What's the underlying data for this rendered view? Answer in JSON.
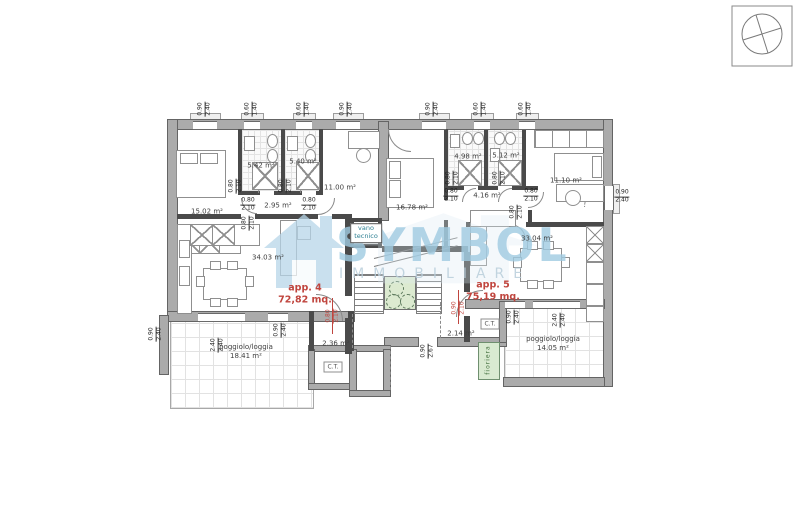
{
  "watermark": {
    "brand": "SYMBOL",
    "subtitle": "IMMOBILIARE"
  },
  "plan": {
    "colors": {
      "exterior_wall": "#ababab",
      "partition_wall": "#4a4a4a",
      "accent_red": "#c0453e",
      "green_planter": "#d9ead1",
      "elevator_green": "#dcead0",
      "watermark_blue": "#a0cbe2",
      "vano_tecnico_text": "#2c7f92"
    },
    "apartments": [
      {
        "name": "apartment-4-label",
        "label": "app. 4",
        "area": "72,82 mq.",
        "x": 305,
        "y": 295
      },
      {
        "name": "apartment-5-label",
        "label": "app. 5",
        "area": "75,19 mq.",
        "x": 493,
        "y": 292
      }
    ],
    "labels": [
      {
        "name": "room-label-15-02",
        "text": "15.02 m²",
        "x": 207,
        "y": 212,
        "cls": "rm"
      },
      {
        "name": "room-label-5-42",
        "text": "5.42 m²",
        "x": 261,
        "y": 166,
        "cls": "rm"
      },
      {
        "name": "room-label-5-40",
        "text": "5.40 m²",
        "x": 303,
        "y": 162,
        "cls": "rm"
      },
      {
        "name": "room-label-11-00",
        "text": "11.00 m²",
        "x": 340,
        "y": 188,
        "cls": "rm"
      },
      {
        "name": "room-label-2-95",
        "text": "2.95 m²",
        "x": 278,
        "y": 206,
        "cls": "rm"
      },
      {
        "name": "room-label-34-03",
        "text": "34.03 m²",
        "x": 268,
        "y": 258,
        "cls": "rm"
      },
      {
        "name": "room-label-16-78",
        "text": "16.78 m²",
        "x": 412,
        "y": 208,
        "cls": "rm"
      },
      {
        "name": "room-label-4-98",
        "text": "4.98 m²",
        "x": 468,
        "y": 157,
        "cls": "rm"
      },
      {
        "name": "room-label-5-12",
        "text": "5.12 m²",
        "x": 506,
        "y": 156,
        "cls": "rm"
      },
      {
        "name": "room-label-11-10",
        "text": "11.10 m²",
        "x": 566,
        "y": 181,
        "cls": "rm"
      },
      {
        "name": "room-label-4-16",
        "text": "4.16 m²",
        "x": 487,
        "y": 196,
        "cls": "rm"
      },
      {
        "name": "room-label-33-04",
        "text": "33.04 m²",
        "x": 537,
        "y": 239,
        "cls": "rm"
      },
      {
        "name": "room-label-2-36",
        "text": "2.36 m²",
        "x": 336,
        "y": 344,
        "cls": "rm"
      },
      {
        "name": "room-label-2-14",
        "text": "2.14 m²",
        "x": 461,
        "y": 334,
        "cls": "rm"
      },
      {
        "name": "loggia-label-left",
        "text": "poggiolo/loggia",
        "text2": "18.41 m²",
        "x": 246,
        "y": 352,
        "cls": "rm"
      },
      {
        "name": "loggia-label-right",
        "text": "poggiolo/loggia",
        "text2": "14.05 m²",
        "x": 553,
        "y": 344,
        "cls": "rm"
      },
      {
        "name": "vano-tecnico-label",
        "text": "vano",
        "text2": "tecnico",
        "x": 366,
        "y": 233,
        "cls": "vt"
      },
      {
        "name": "ct-label-left",
        "text": "C.T.",
        "x": 333,
        "y": 367,
        "cls": "ct"
      },
      {
        "name": "ct-label-right",
        "text": "C.T.",
        "x": 490,
        "y": 324,
        "cls": "ct"
      },
      {
        "name": "fioriera-label",
        "text": "fioriera",
        "x": 488,
        "y": 360,
        "cls": "fio",
        "rot": -90
      }
    ],
    "dims": [
      {
        "name": "dim-top-1",
        "num": "0.90",
        "den": "2.40",
        "x": 205,
        "y": 109,
        "rot": -90
      },
      {
        "name": "dim-top-2",
        "num": "0.60",
        "den": "1.40",
        "x": 252,
        "y": 109,
        "rot": -90
      },
      {
        "name": "dim-top-3",
        "num": "0.60",
        "den": "1.40",
        "x": 304,
        "y": 109,
        "rot": -90
      },
      {
        "name": "dim-top-4",
        "num": "0.90",
        "den": "2.40",
        "x": 347,
        "y": 109,
        "rot": -90
      },
      {
        "name": "dim-top-5",
        "num": "0.90",
        "den": "2.40",
        "x": 433,
        "y": 109,
        "rot": -90
      },
      {
        "name": "dim-top-6",
        "num": "0.60",
        "den": "1.40",
        "x": 481,
        "y": 109,
        "rot": -90
      },
      {
        "name": "dim-top-7",
        "num": "0.60",
        "den": "1.40",
        "x": 526,
        "y": 109,
        "rot": -90
      },
      {
        "name": "dim-right",
        "num": "0.90",
        "den": "2.40",
        "x": 622,
        "y": 197,
        "rot": 0
      },
      {
        "name": "dim-door-1",
        "num": "0.80",
        "den": "2.10",
        "x": 248,
        "y": 205,
        "rot": 0
      },
      {
        "name": "dim-door-2",
        "num": "0.80",
        "den": "2.10",
        "x": 309,
        "y": 205,
        "rot": 0
      },
      {
        "name": "dim-door-3",
        "num": "0.80",
        "den": "2.10",
        "x": 451,
        "y": 196,
        "rot": 0
      },
      {
        "name": "dim-door-4",
        "num": "0.80",
        "den": "2.10",
        "x": 531,
        "y": 196,
        "rot": 0
      },
      {
        "name": "dim-door-5",
        "num": "0.80",
        "den": "2.10",
        "x": 236,
        "y": 186,
        "rot": -90
      },
      {
        "name": "dim-door-6",
        "num": "0.80",
        "den": "2.10",
        "x": 286,
        "y": 186,
        "rot": -90
      },
      {
        "name": "dim-door-7",
        "num": "0.80",
        "den": "2.10",
        "x": 453,
        "y": 178,
        "rot": -90
      },
      {
        "name": "dim-door-8",
        "num": "0.80",
        "den": "2.10",
        "x": 500,
        "y": 178,
        "rot": -90
      },
      {
        "name": "dim-door-9",
        "num": "0.80",
        "den": "2.10",
        "x": 517,
        "y": 212,
        "rot": -90
      },
      {
        "name": "dim-door-10",
        "num": "0.80",
        "den": "2.10",
        "x": 249,
        "y": 223,
        "rot": -90
      },
      {
        "name": "dim-entry-4",
        "num": "0.80",
        "den": "2.10",
        "x": 333,
        "y": 316,
        "rot": -90,
        "red": true
      },
      {
        "name": "dim-entry-5",
        "num": "0.90",
        "den": "2.10",
        "x": 459,
        "y": 308,
        "rot": -90,
        "red": true
      },
      {
        "name": "dim-bottom-center",
        "num": "0.90",
        "den": "2.67",
        "x": 428,
        "y": 351,
        "rot": -90
      },
      {
        "name": "dim-loggia-1",
        "num": "2.40",
        "den": "2.40",
        "x": 218,
        "y": 345,
        "rot": -90
      },
      {
        "name": "dim-loggia-2",
        "num": "0.90",
        "den": "2.40",
        "x": 281,
        "y": 330,
        "rot": -90
      },
      {
        "name": "dim-loggia-3",
        "num": "0.90",
        "den": "2.40",
        "x": 156,
        "y": 334,
        "rot": -90
      },
      {
        "name": "dim-loggia-4",
        "num": "0.90",
        "den": "2.40",
        "x": 514,
        "y": 317,
        "rot": -90
      },
      {
        "name": "dim-loggia-5",
        "num": "2.40",
        "den": "2.40",
        "x": 560,
        "y": 320,
        "rot": -90
      }
    ]
  }
}
